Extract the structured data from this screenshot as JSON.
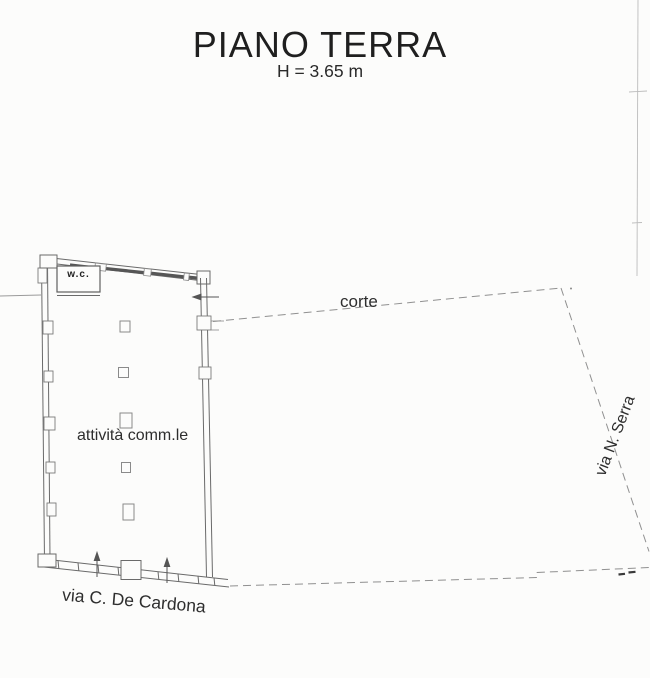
{
  "canvas": {
    "background": "#fcfcfb",
    "wall_ink": "#5a5a5a",
    "thin_ink": "#7a7a7a",
    "dash_ink": "#909090",
    "faint_ink": "#bbbbbb",
    "text_ink": "#2e2e2e"
  },
  "header": {
    "title": "PIANO TERRA",
    "height_note": "H = 3.65 m"
  },
  "labels": {
    "wc": "w.c.",
    "main_room": "attività comm.le",
    "courtyard": "corte",
    "street_right": "via N. Serra",
    "street_bottom": "via C. De Cardona"
  }
}
